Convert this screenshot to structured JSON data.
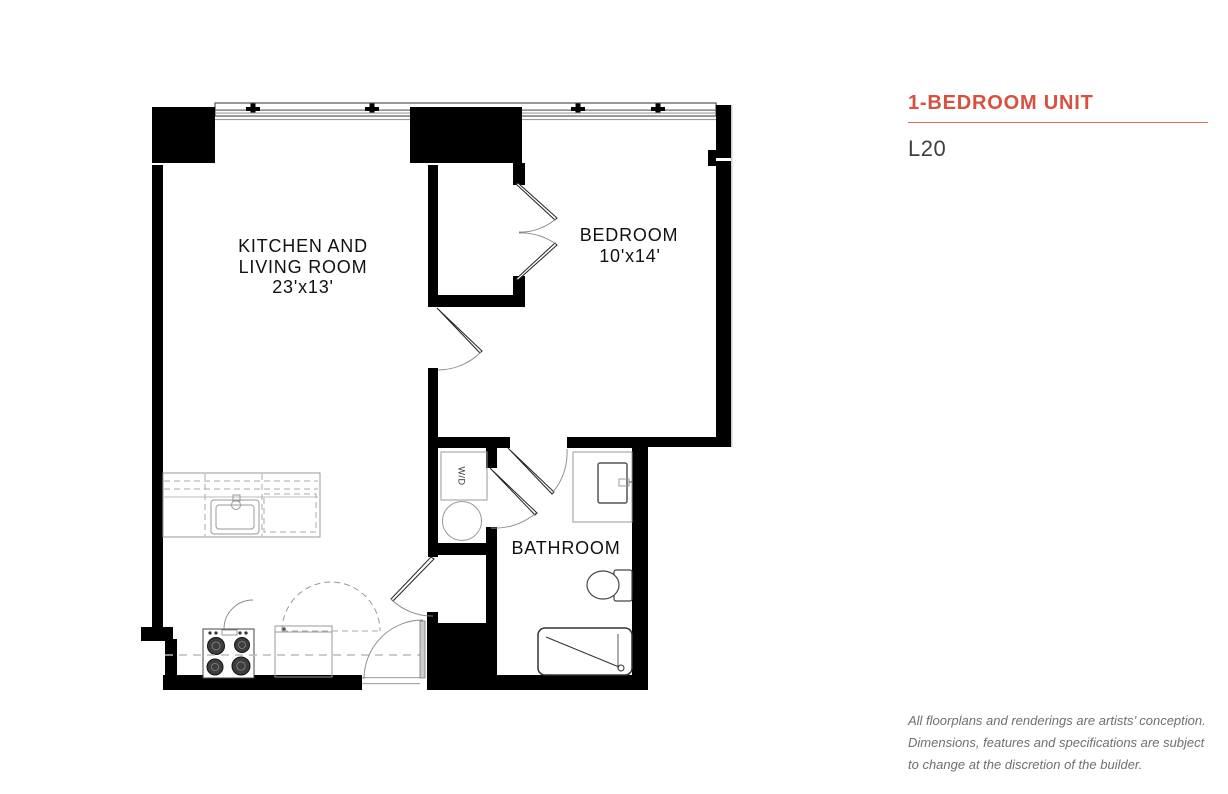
{
  "panel": {
    "title": "1-BEDROOM UNIT",
    "unit_label": "L20",
    "disclaimer": "All floorplans and renderings are artists’ conception. Dimensions, features and specifications are subject to change at the discretion of the builder."
  },
  "floorplan": {
    "kitchen_living": {
      "name_line1": "KITCHEN AND",
      "name_line2": "LIVING ROOM",
      "dimensions": "23'x13'"
    },
    "bedroom": {
      "name": "BEDROOM",
      "dimensions": "10'x14'"
    },
    "bathroom": {
      "name": "BATHROOM"
    },
    "washer_dryer": {
      "abbr": "W/D"
    }
  },
  "colors": {
    "accent": "#D8503F",
    "accent_rule": "#DC6A57",
    "wall": "#000000",
    "room_label": "#111111",
    "unit_text": "#3F3F3F",
    "disclaimer_text": "#6F6F6F",
    "background": "#FFFFFF"
  }
}
